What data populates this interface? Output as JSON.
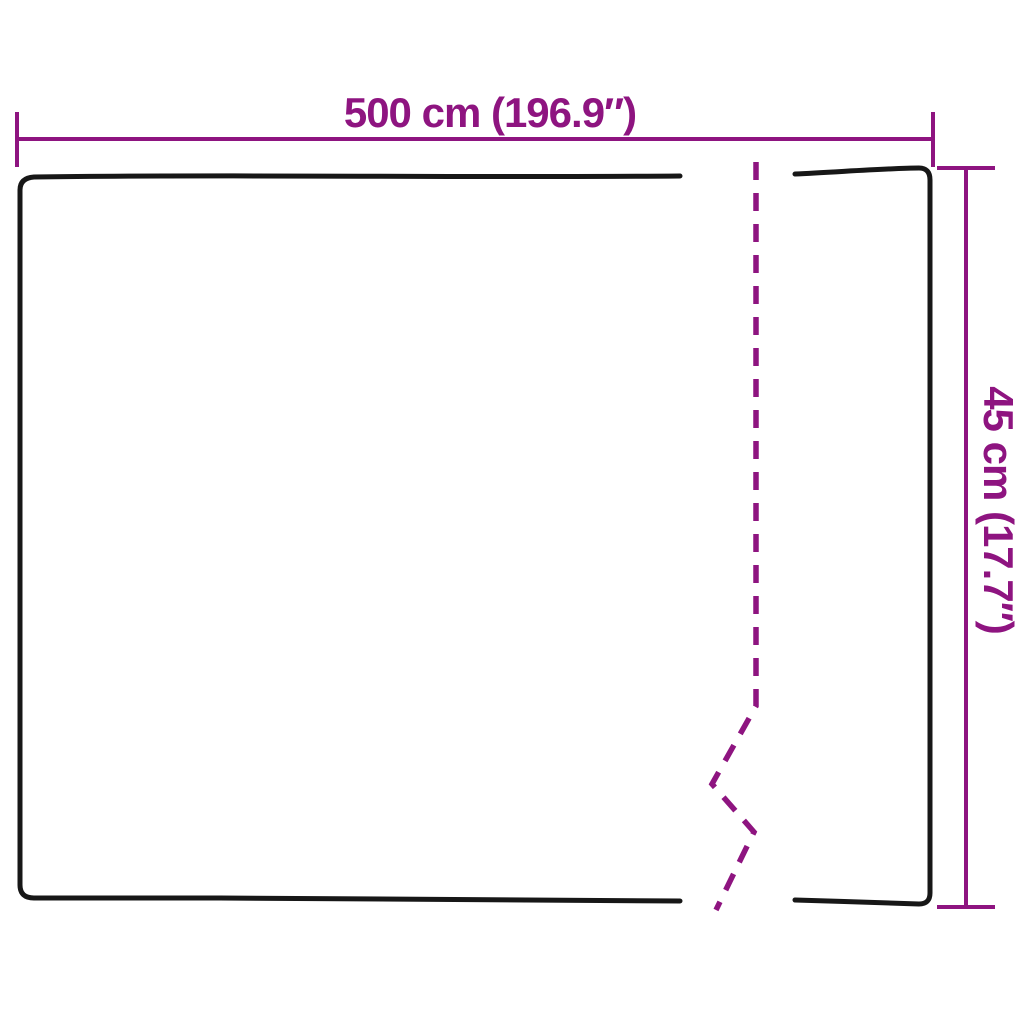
{
  "dimensions": {
    "width": {
      "label": "500 cm (196.9″)"
    },
    "height": {
      "label": "45 cm (17.7″)"
    }
  },
  "colors": {
    "dimension": "#8e1480",
    "outline": "#171717",
    "background": "#ffffff"
  }
}
